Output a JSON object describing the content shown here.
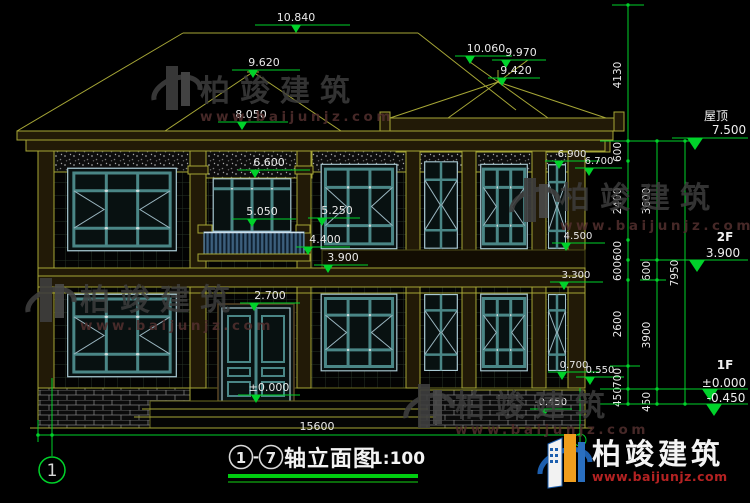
{
  "drawing": {
    "title_axis_start": "1",
    "title_sep": "-",
    "title_axis_end": "7",
    "title_text": "轴立面图",
    "title_scale": "1:100",
    "axis_bubble": "1",
    "total_width_dim": "15600"
  },
  "levels": {
    "roof_label": "屋顶",
    "roof": "7.500",
    "f2_label": "2F",
    "f2": "3.900",
    "f1_label": "1F",
    "zero": "±0.000",
    "below": "-0.450"
  },
  "marks": {
    "ridge": "10.840",
    "peak_left": "9.620",
    "slope_left": "8.050",
    "tower_fin1": "10.060",
    "tower_fin2": "9.970",
    "tower_apex": "9.420",
    "frieze": "6.600",
    "c1": "5.250",
    "balcony": "5.050",
    "c2": "4.400",
    "c3": "3.900",
    "door": "2.700",
    "door_zero": "±0.000",
    "r1": "6.900",
    "r2": "6.700",
    "r3": "4.500",
    "r4": "3.300",
    "r5": "0.700",
    "r6": "0.550",
    "r7": "-0.450"
  },
  "dims": {
    "colA": [
      "4130",
      "600",
      "2400",
      "600",
      "600",
      "2600",
      "700",
      "450"
    ],
    "colB": [
      "3600",
      "600",
      "3900",
      "450"
    ],
    "colC": [
      "7950"
    ]
  },
  "watermark": {
    "brand": "柏竣建筑",
    "url": "www.baijunjz.com"
  },
  "logo": {
    "brand": "柏竣建筑",
    "url": "www.baijunjz.com"
  },
  "colors": {
    "background": "#000000",
    "linework_yellow": "#a6a636",
    "dimension_green": "#00d22a",
    "text_white": "#e9e9e9",
    "window_teal": "#4a8686",
    "title_underline": "#00cc10",
    "logo_blue": "#1d5fae",
    "logo_orange": "#ef9d1d",
    "logo_url_red": "#b42222",
    "watermark_gray": "#3e3e3e"
  }
}
